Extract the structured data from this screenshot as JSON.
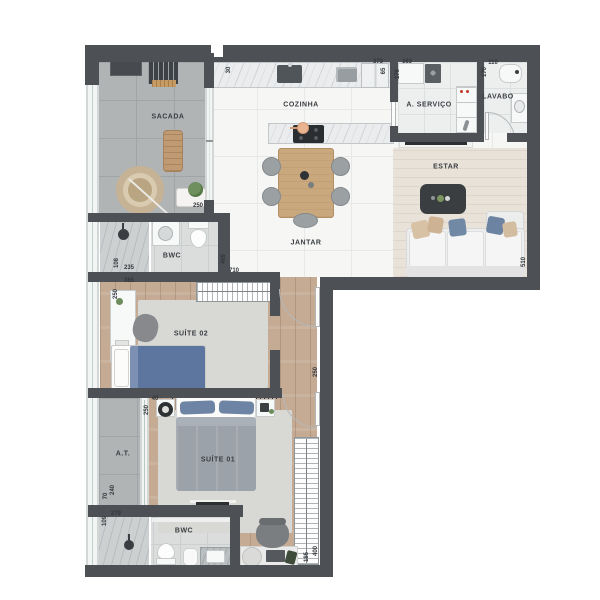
{
  "plan": {
    "type": "apartment-floor-plan",
    "colors": {
      "wall": "#4d5156",
      "wood_floor": "#c5ab94",
      "gray_tile": "#b1b4b5",
      "white_tile": "#f6f6f5",
      "rug_beige": "#e9e2d9",
      "rug_gray": "#d8d8d5",
      "accent_blue": "#6e84a4",
      "accent_wood": "#c9a87e"
    }
  },
  "rooms": [
    {
      "id": "sacada",
      "label": "SACADA",
      "x": 168,
      "y": 117
    },
    {
      "id": "cozinha",
      "label": "COZINHA",
      "x": 301,
      "y": 105
    },
    {
      "id": "a-servico",
      "label": "A. SERVIÇO",
      "x": 429,
      "y": 105
    },
    {
      "id": "lavabo",
      "label": "LAVABO",
      "x": 498,
      "y": 97
    },
    {
      "id": "estar",
      "label": "ESTAR",
      "x": 446,
      "y": 167
    },
    {
      "id": "jantar",
      "label": "JANTAR",
      "x": 306,
      "y": 243
    },
    {
      "id": "bwc-suite-02",
      "label": "BWC",
      "x": 172,
      "y": 256
    },
    {
      "id": "suite-02",
      "label": "SUÍTE 02",
      "x": 191,
      "y": 334
    },
    {
      "id": "at",
      "label": "A.T.",
      "x": 123,
      "y": 454
    },
    {
      "id": "suite-01",
      "label": "SUÍTE 01",
      "x": 218,
      "y": 460
    },
    {
      "id": "bwc-suite-01",
      "label": "BWC",
      "x": 184,
      "y": 531
    }
  ],
  "dimensions": [
    {
      "text": "30",
      "x": 229,
      "y": 70,
      "rot": 1
    },
    {
      "text": "373",
      "x": 378,
      "y": 62,
      "rot": 0
    },
    {
      "text": "65",
      "x": 384,
      "y": 71,
      "rot": 1
    },
    {
      "text": "163",
      "x": 407,
      "y": 62,
      "rot": 0
    },
    {
      "text": "170",
      "x": 398,
      "y": 74,
      "rot": 1
    },
    {
      "text": "110",
      "x": 493,
      "y": 63,
      "rot": 0
    },
    {
      "text": "170",
      "x": 485,
      "y": 72,
      "rot": 1
    },
    {
      "text": "510",
      "x": 524,
      "y": 262,
      "rot": 1
    },
    {
      "text": "250",
      "x": 198,
      "y": 206,
      "rot": 0
    },
    {
      "text": "465",
      "x": 224,
      "y": 259,
      "rot": 1
    },
    {
      "text": "710",
      "x": 234,
      "y": 271,
      "rot": 0
    },
    {
      "text": "108",
      "x": 117,
      "y": 263,
      "rot": 1
    },
    {
      "text": "235",
      "x": 129,
      "y": 268,
      "rot": 0
    },
    {
      "text": "365",
      "x": 129,
      "y": 281,
      "rot": 0
    },
    {
      "text": "250",
      "x": 116,
      "y": 294,
      "rot": 1
    },
    {
      "text": "40",
      "x": 155,
      "y": 399,
      "rot": 0
    },
    {
      "text": "250",
      "x": 147,
      "y": 410,
      "rot": 1
    },
    {
      "text": "250",
      "x": 316,
      "y": 372,
      "rot": 1
    },
    {
      "text": "70",
      "x": 106,
      "y": 496,
      "rot": 1
    },
    {
      "text": "240",
      "x": 113,
      "y": 490,
      "rot": 1
    },
    {
      "text": "279",
      "x": 116,
      "y": 514,
      "rot": 0
    },
    {
      "text": "109",
      "x": 105,
      "y": 521,
      "rot": 1
    },
    {
      "text": "185",
      "x": 307,
      "y": 557,
      "rot": 1
    },
    {
      "text": "400",
      "x": 316,
      "y": 551,
      "rot": 1
    }
  ]
}
